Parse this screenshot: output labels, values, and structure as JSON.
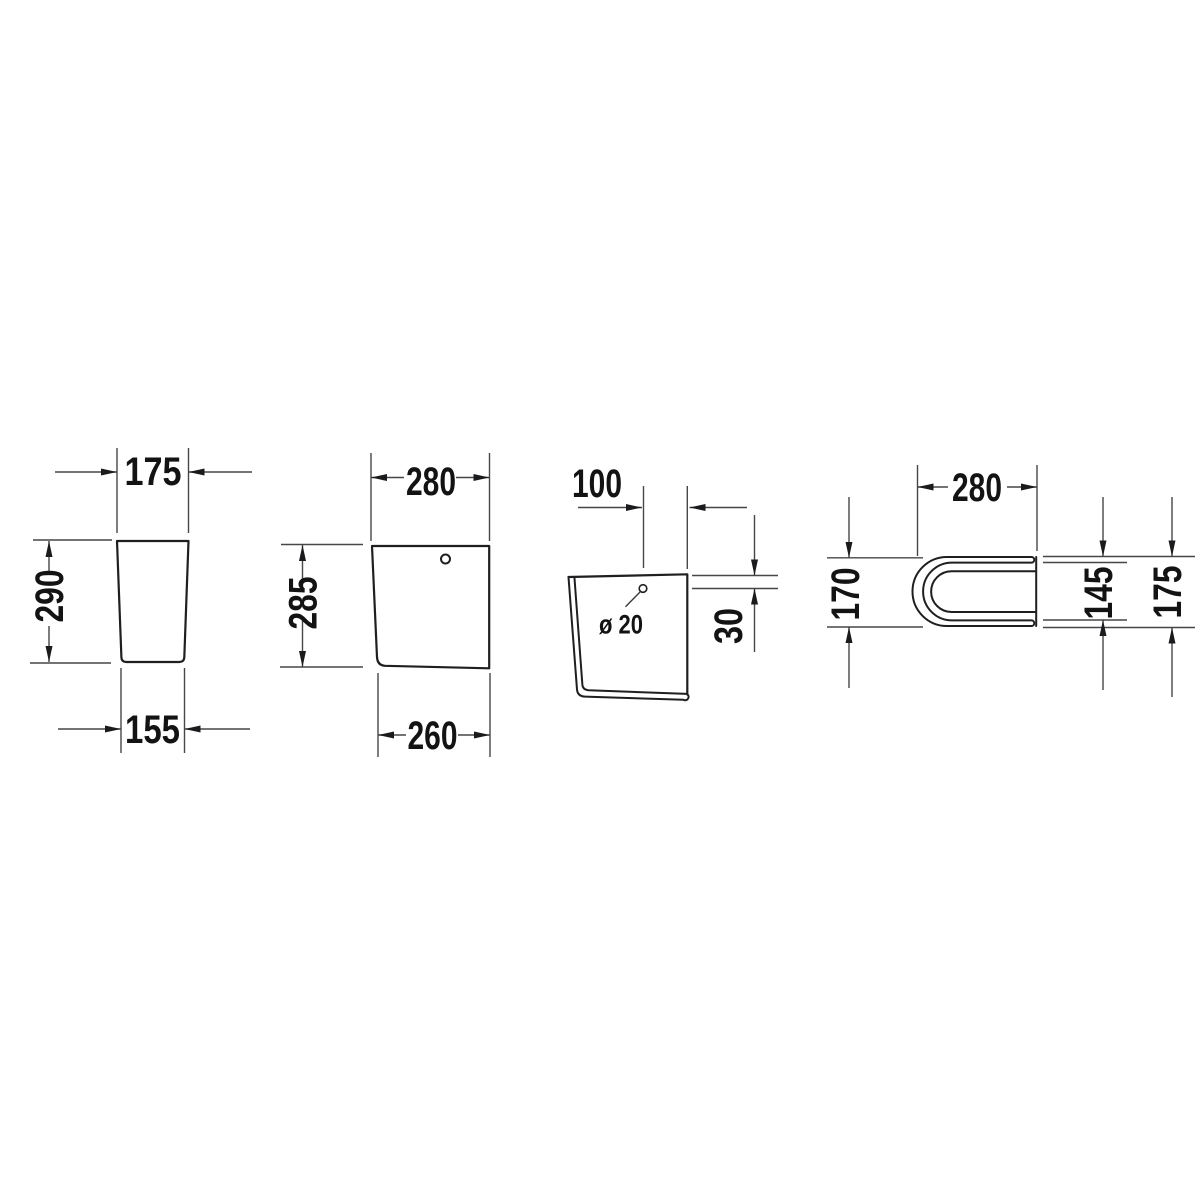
{
  "drawing": {
    "title": "technical-dimension-drawing",
    "colors": {
      "background": "#ffffff",
      "outline": "#1f1f21",
      "dimension_lines": "#47474a",
      "text": "#131313"
    },
    "front_view": {
      "width_top": "175",
      "height": "290",
      "width_bottom": "155"
    },
    "side_view": {
      "width_top": "280",
      "height": "285",
      "width_bottom": "260"
    },
    "section_view": {
      "hole_offset": "100",
      "hole_diameter": "ø 20",
      "hole_depth_from_top": "30"
    },
    "top_view": {
      "width": "280",
      "depth_outer": "170",
      "depth_inner": "145",
      "depth_total": "175"
    }
  }
}
